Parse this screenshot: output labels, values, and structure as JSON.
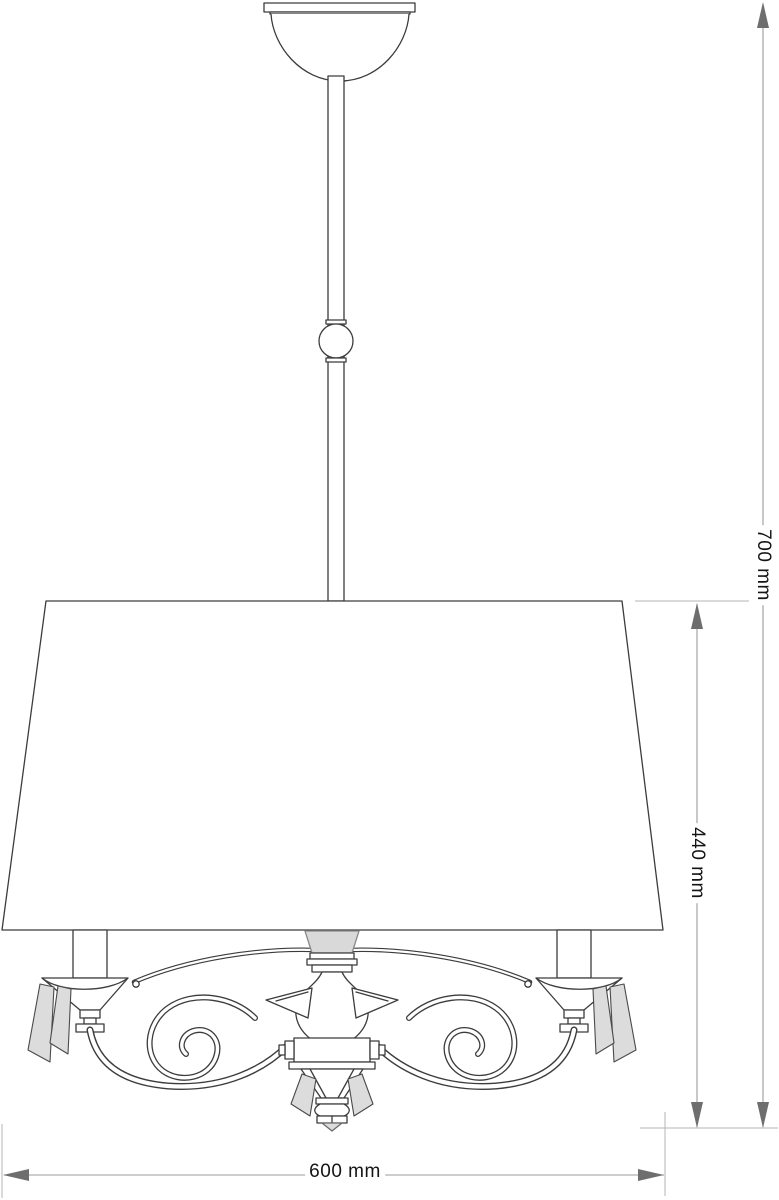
{
  "drawing": {
    "subject": "three-arm pendant chandelier with tapered drum shade, ceiling canopy, hanging rod with ball, candle sleeves, scroll arms and crystal pendants",
    "style": "black-and-white technical dimension drawing",
    "dimensions": {
      "overall_height": {
        "label": "700 mm",
        "value": 700,
        "unit": "mm",
        "orientation": "vertical"
      },
      "body_height": {
        "label": "440 mm",
        "value": 440,
        "unit": "mm",
        "orientation": "vertical"
      },
      "shade_width": {
        "label": "600 mm",
        "value": 600,
        "unit": "mm",
        "orientation": "horizontal"
      }
    },
    "colors": {
      "background": "#ffffff",
      "outline": "#3c3c3c",
      "dimension_line": "#9b9b9b",
      "extension_line": "#b5b5b5",
      "arrow_fill": "#6e6e6e",
      "label_text": "#141414",
      "crystal_fill": "#dcdcdc",
      "candle_shade_fill": "#d9d9d9"
    }
  }
}
